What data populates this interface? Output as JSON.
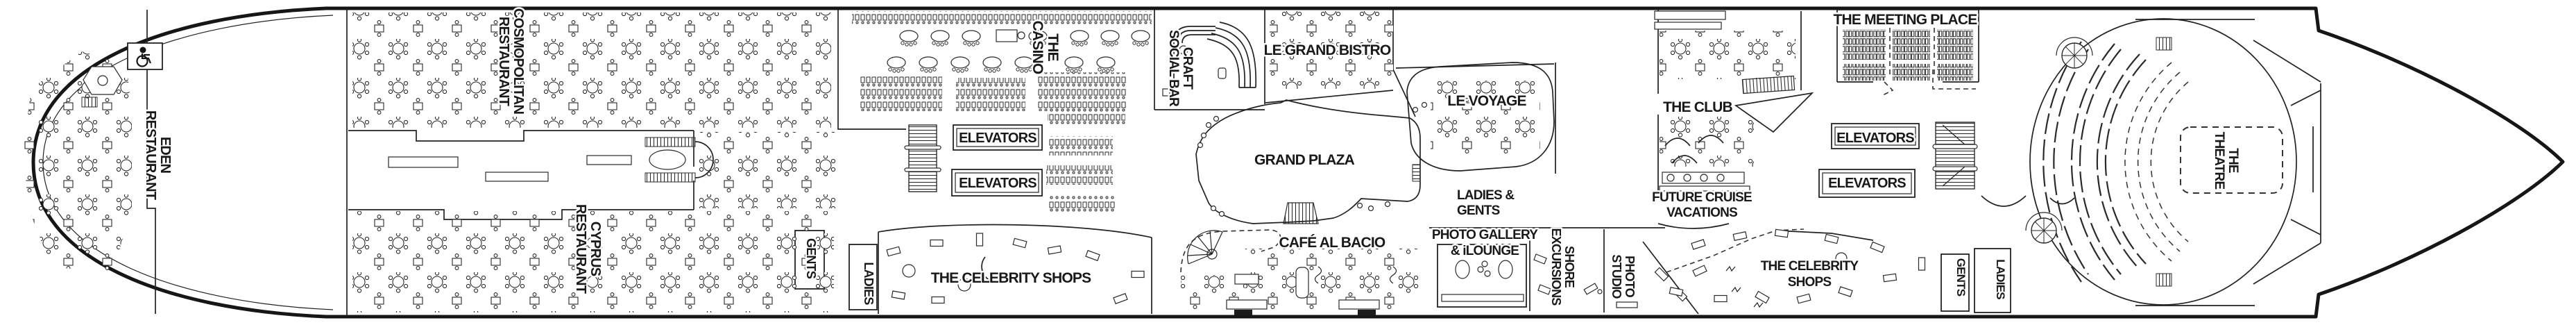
{
  "colors": {
    "ink": "#191919",
    "paper": "#ffffff"
  },
  "icons": [
    {
      "name": "wheelchair-accessible-icon",
      "glyph": "wheelchair"
    }
  ],
  "venues": [
    {
      "id": "eden-restaurant",
      "lines": [
        "EDEN",
        "RESTAURANT"
      ]
    },
    {
      "id": "cosmopolitan-restaurant",
      "lines": [
        "COSMOPOLITAN",
        "RESTAURANT"
      ]
    },
    {
      "id": "cyprus-restaurant",
      "lines": [
        "CYPRUS",
        "RESTAURANT"
      ]
    },
    {
      "id": "gents-midship",
      "lines": [
        "GENTS"
      ]
    },
    {
      "id": "ladies-midship",
      "lines": [
        "LADIES"
      ]
    },
    {
      "id": "the-casino",
      "lines": [
        "THE",
        "CASINO"
      ]
    },
    {
      "id": "elevators-midship-upper",
      "lines": [
        "ELEVATORS"
      ]
    },
    {
      "id": "elevators-midship-lower",
      "lines": [
        "ELEVATORS"
      ]
    },
    {
      "id": "celebrity-shops-midship",
      "lines": [
        "THE CELEBRITY SHOPS"
      ]
    },
    {
      "id": "craft-social-bar",
      "lines": [
        "CRAFT",
        "SOCIAL BAR"
      ]
    },
    {
      "id": "le-grand-bistro",
      "lines": [
        "LE GRAND BISTRO"
      ]
    },
    {
      "id": "grand-plaza",
      "lines": [
        "GRAND PLAZA"
      ]
    },
    {
      "id": "cafe-al-bacio",
      "lines": [
        "CAFÉ AL BACIO"
      ]
    },
    {
      "id": "le-voyage",
      "lines": [
        "LE VOYAGE"
      ]
    },
    {
      "id": "ladies-and-gents",
      "lines": [
        "LADIES &",
        "GENTS"
      ]
    },
    {
      "id": "photo-gallery-ilounge",
      "lines": [
        "PHOTO GALLERY",
        "& iLOUNGE"
      ]
    },
    {
      "id": "shore-excursions",
      "lines": [
        "SHORE",
        "EXCURSIONS"
      ]
    },
    {
      "id": "photo-studio",
      "lines": [
        "PHOTO",
        "STUDIO"
      ]
    },
    {
      "id": "the-club",
      "lines": [
        "THE CLUB"
      ]
    },
    {
      "id": "future-cruise-vacations",
      "lines": [
        "FUTURE CRUISE",
        "VACATIONS"
      ]
    },
    {
      "id": "the-meeting-place",
      "lines": [
        "THE MEETING PLACE"
      ]
    },
    {
      "id": "elevators-forward-upper",
      "lines": [
        "ELEVATORS"
      ]
    },
    {
      "id": "elevators-forward-lower",
      "lines": [
        "ELEVATORS"
      ]
    },
    {
      "id": "celebrity-shops-forward",
      "lines": [
        "THE CELEBRITY",
        "SHOPS"
      ]
    },
    {
      "id": "gents-forward",
      "lines": [
        "GENTS"
      ]
    },
    {
      "id": "ladies-forward",
      "lines": [
        "LADIES"
      ]
    },
    {
      "id": "the-theatre",
      "lines": [
        "THE",
        "THEATRE"
      ]
    }
  ]
}
